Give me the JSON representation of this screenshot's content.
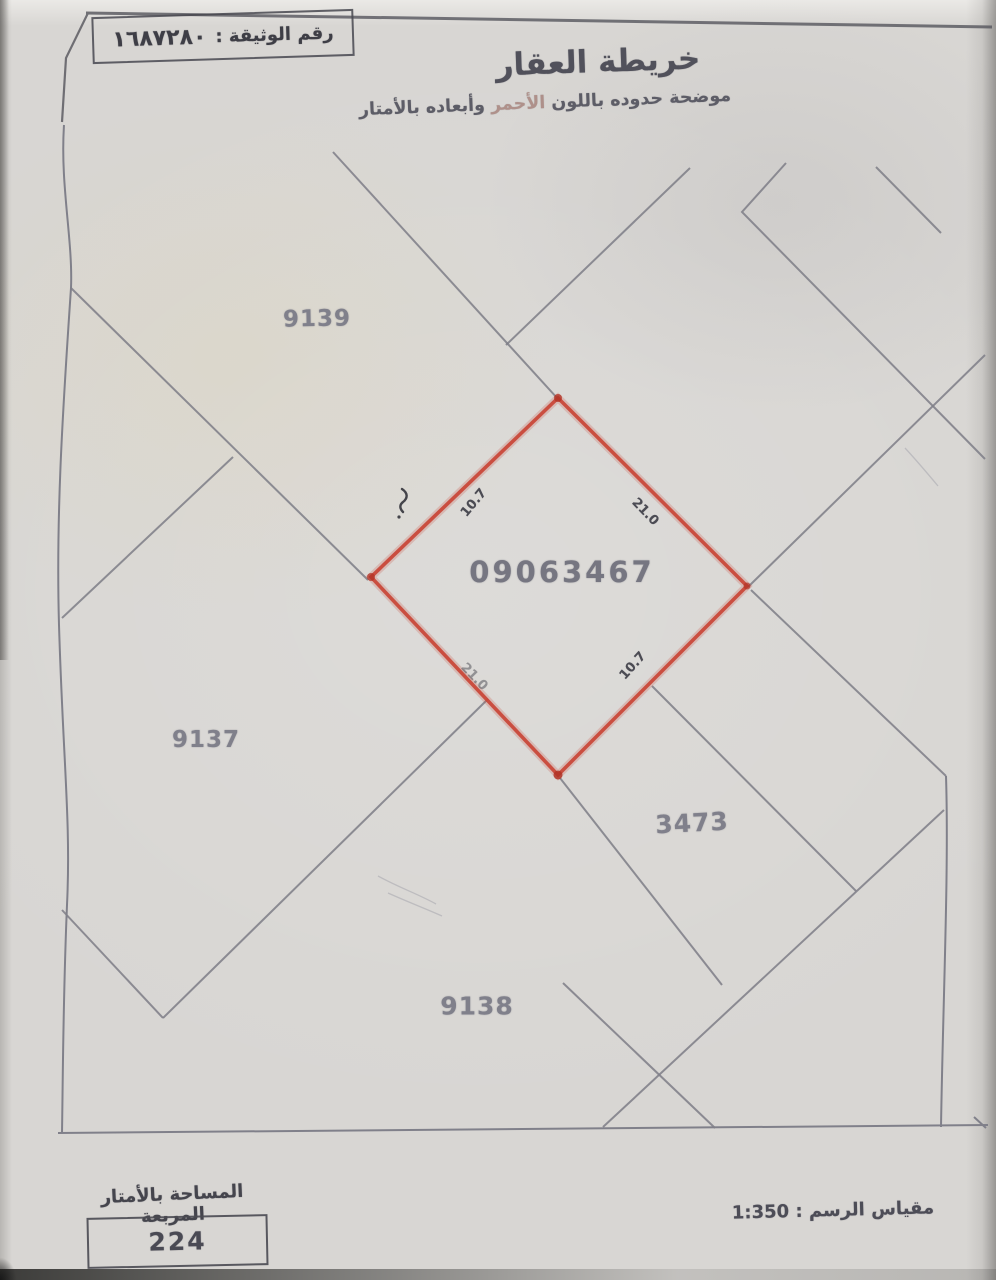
{
  "header": {
    "doc_number_label": "رقم الوثيقة :",
    "doc_number_value": "١٦٨٧٢٨٠",
    "title": "خريطة العقار",
    "subtitle_part1": "موضحة حدوده باللون",
    "subtitle_part2": "الأحمر",
    "subtitle_part3": "وأبعاده بالأمتار"
  },
  "map": {
    "target_parcel": {
      "number": "09063467",
      "boundary_color": "#c94436",
      "dimensions": {
        "top_left": "10.7",
        "top_right": "21.0",
        "bottom_right": "10.7",
        "bottom_left": "21.0"
      }
    },
    "neighbor_parcels": [
      {
        "number": "9139"
      },
      {
        "number": "9137"
      },
      {
        "number": "3473"
      },
      {
        "number": "9138"
      }
    ]
  },
  "footer": {
    "area_label": "المساحة بالأمتار المربعة",
    "area_value": "224",
    "scale_label": "مقياس الرسم : 1:350"
  }
}
